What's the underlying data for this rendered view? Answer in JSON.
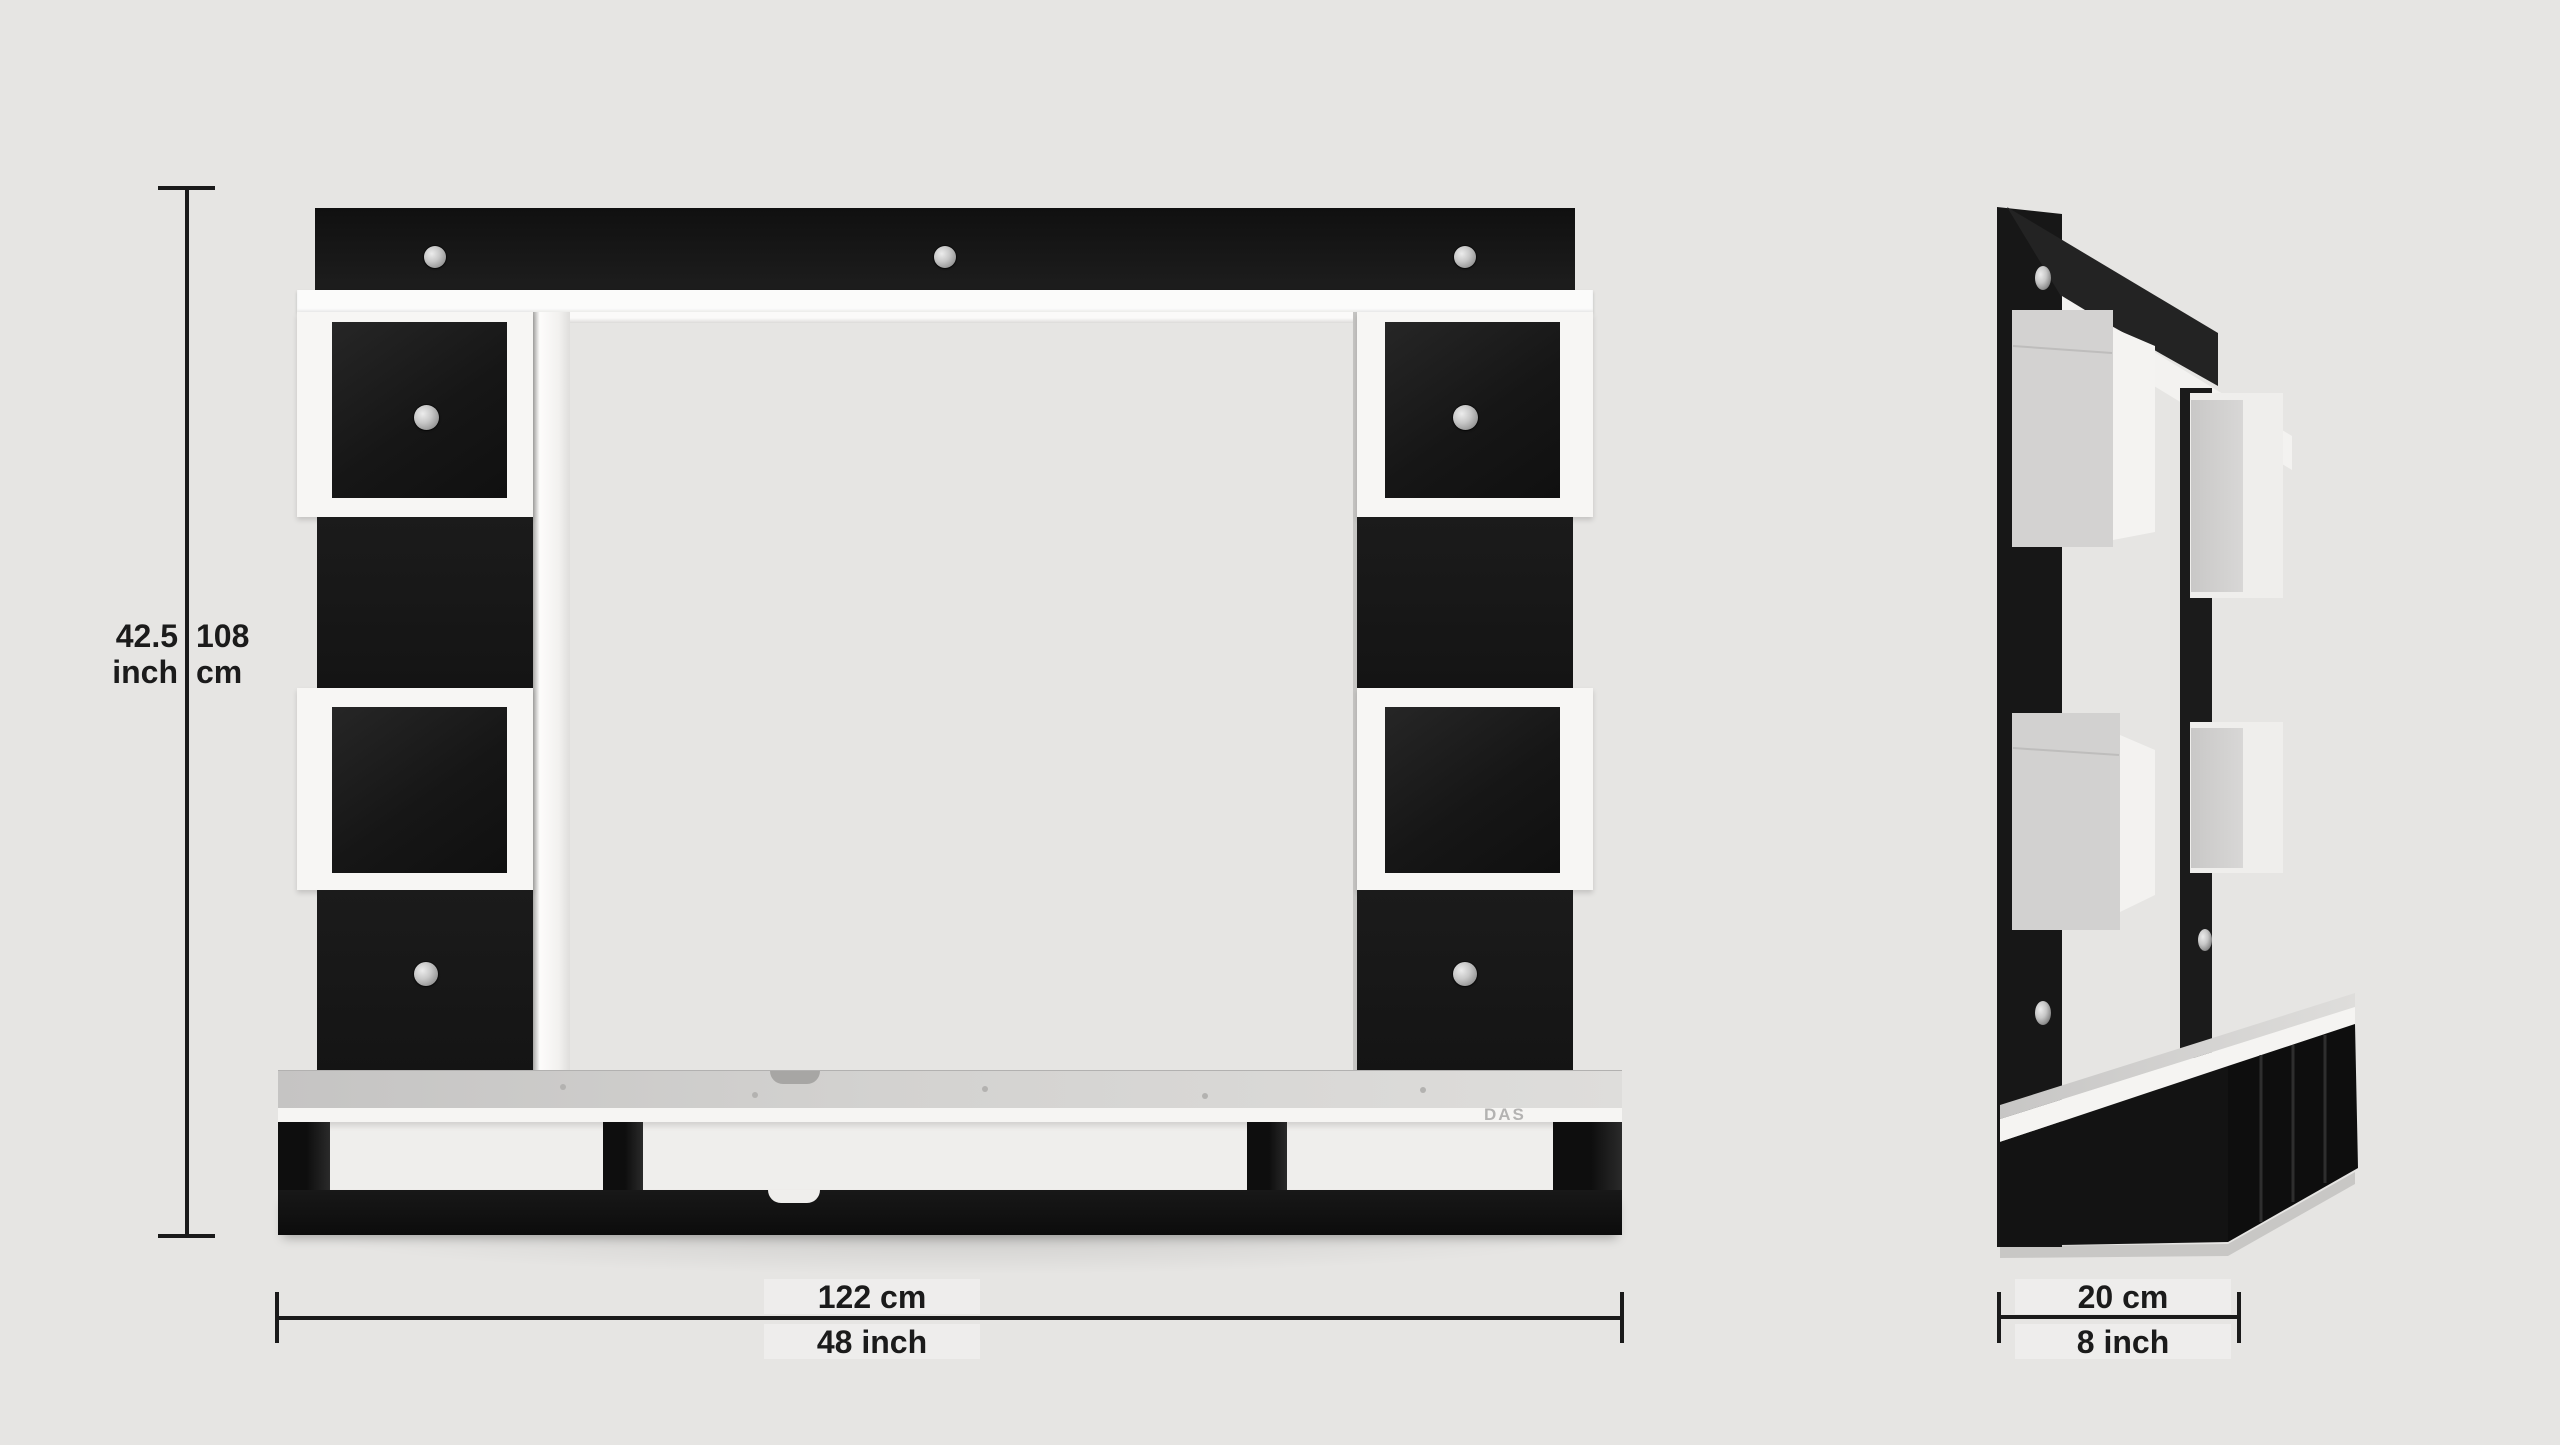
{
  "page": {
    "title": "Wall mounted TV entertainment unit dimension diagram",
    "views": {
      "front_view": "front elevation with width and height dimensions",
      "side_view": "side perspective with depth dimension"
    }
  },
  "dimensions": {
    "height": {
      "imperial_value": "42.5",
      "imperial_unit": "inch",
      "metric_value": "108",
      "metric_unit": "cm"
    },
    "width": {
      "metric": "122 cm",
      "imperial": "48 inch"
    },
    "depth": {
      "metric": "20 cm",
      "imperial": "8 inch"
    }
  },
  "brand": {
    "logo_text": "DAS"
  },
  "icons": {
    "screw_cap": "silver-circle",
    "cable_notch": "half-circle-cutout"
  },
  "colors": {
    "background": "#e6e5e3",
    "panel_black": "#161616",
    "white": "#f7f6f4",
    "shelf_top_gray": "#cfcecc",
    "dimension_line": "#1a1a1a",
    "text": "#1b1b1b",
    "logo_gray": "#b4b3b2",
    "screw_silver": "#c7c7c7"
  }
}
